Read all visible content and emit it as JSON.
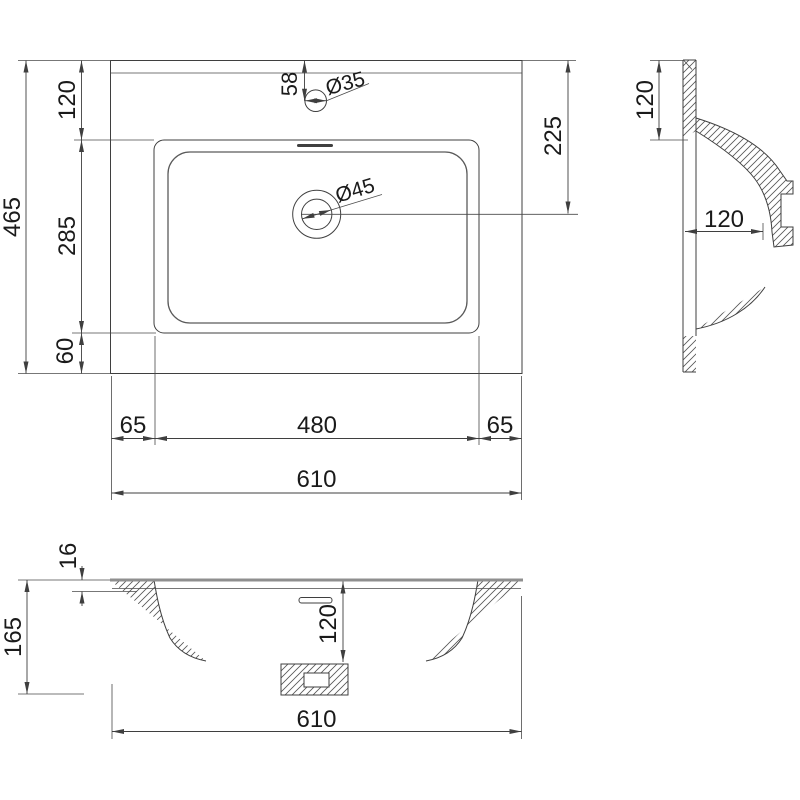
{
  "drawing": {
    "type": "washbasin technical drawing, three orthographic views with dimensions in mm",
    "views": {
      "plan": {
        "total_width": "610",
        "total_depth": "465",
        "band_top": "120",
        "basin_depth": "285",
        "band_bottom": "60",
        "margin_left": "65",
        "basin_width": "480",
        "margin_right": "65",
        "faucet_offset": "58",
        "faucet_hole": "Ø35",
        "drain_hole": "Ø45",
        "drain_offset": "225"
      },
      "side": {
        "rim_to_overflow": "120",
        "ledge_depth": "120"
      },
      "front": {
        "rim_thickness": "16",
        "total_height": "165",
        "bowl_depth": "120",
        "total_width": "610"
      }
    },
    "colors": {
      "line": "#3f3f3f",
      "accent_gray": "#8f8f8f",
      "background": "#ffffff"
    }
  }
}
